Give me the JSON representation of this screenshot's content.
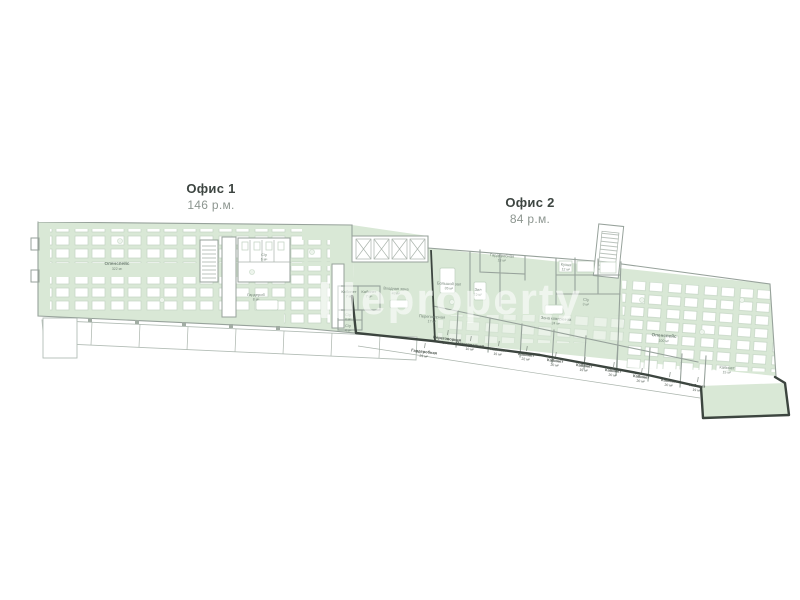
{
  "watermark": {
    "text": "eproperty"
  },
  "offices": {
    "office1": {
      "title": "Офис 1",
      "capacity": "146 р.м."
    },
    "office2": {
      "title": "Офис 2",
      "capacity": "84 р.м."
    }
  },
  "plan": {
    "colors": {
      "room_fill": "#d9e8d6",
      "wall": "#97a29b",
      "offer_boundary": "#3c453f",
      "room_label": "#76867a",
      "callout_label": "#49524b",
      "desk_fill": "#ffffff",
      "watermark": "#ffffff"
    },
    "rooms": [
      {
        "label": "Опенспейс",
        "area": "322 м²"
      },
      {
        "label": "Гардероб",
        "area": "8 м²"
      },
      {
        "label": "С/у",
        "area": "6 м²"
      },
      {
        "label": "Кабинет",
        "area": "7 м²"
      },
      {
        "label": "Кабинет",
        "area": "7 м²"
      },
      {
        "label": "С/у",
        "area": "4 м²"
      },
      {
        "label": "С/у",
        "area": "4 м²"
      },
      {
        "label": "Входная зона",
        "area": "43 м²"
      },
      {
        "label": "Большой зал",
        "area": "35 м²"
      },
      {
        "label": "Зал",
        "area": "15 м²"
      },
      {
        "label": "Переговорная",
        "area": "17 м²"
      },
      {
        "label": "Гардеробная",
        "area": "13 м²"
      },
      {
        "label": "Кухня",
        "area": "12 м²"
      },
      {
        "label": "С/у",
        "area": "3 м²"
      },
      {
        "label": "Зона коворкинга",
        "area": "24 м²"
      },
      {
        "label": "Опенспейс",
        "area": "100 м²"
      },
      {
        "label": "Кабинет",
        "area": "15 м²"
      }
    ],
    "callouts": [
      {
        "label": "Гардеробная",
        "area": "23 м²"
      },
      {
        "label": "Переговорная",
        "area": "10 м²"
      },
      {
        "label": "Переговорная",
        "area": "10 м²"
      },
      {
        "label": "Кабинет",
        "area": "15 м²"
      },
      {
        "label": "Кабинет",
        "area": "22 м²"
      },
      {
        "label": "Кабинет",
        "area": "20 м²"
      },
      {
        "label": "Кабинет",
        "area": "15 м²"
      },
      {
        "label": "Кабинет",
        "area": "20 м²"
      },
      {
        "label": "Кабинет",
        "area": "20 м²"
      },
      {
        "label": "Кабинет",
        "area": "20 м²"
      },
      {
        "label": "Кабинет",
        "area": "19 м²"
      }
    ]
  }
}
